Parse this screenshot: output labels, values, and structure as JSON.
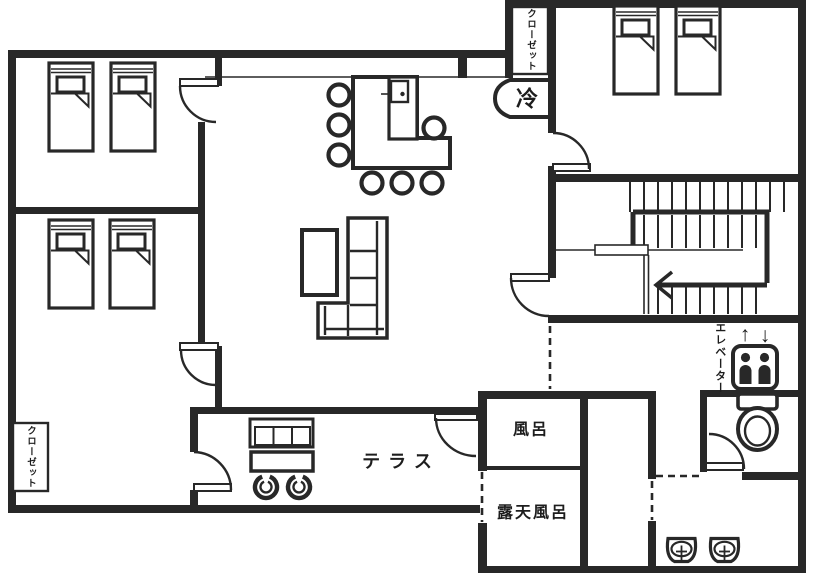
{
  "colors": {
    "wall": "#282828",
    "background": "#ffffff"
  },
  "labels": {
    "closet_top": "クローゼット",
    "closet_bottom_left": "クローゼット",
    "refrigerator": "冷",
    "bath": "風呂",
    "open_air_bath": "露天風呂",
    "terrace": "テラス",
    "elevator": "エレベーター",
    "elevator_up_arrow": "↑",
    "elevator_down_arrow": "↓"
  }
}
